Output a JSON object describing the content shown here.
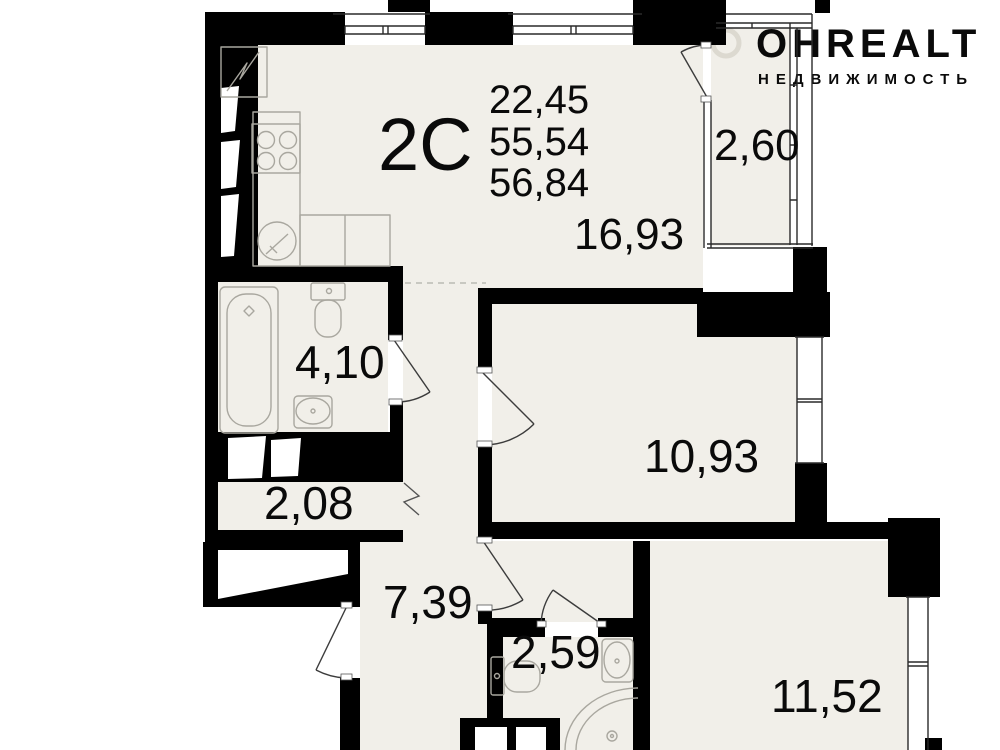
{
  "plan": {
    "unit": {
      "label": "2С",
      "area_living": "22,45",
      "area_total": "55,54",
      "area_total_with_summer": "56,84"
    },
    "rooms": {
      "kitchen_living": {
        "area": "16,93"
      },
      "balcony": {
        "area": "2,60"
      },
      "bathroom": {
        "area": "4,10"
      },
      "storage": {
        "area": "2,08"
      },
      "hallway": {
        "area": "7,39"
      },
      "bedroom": {
        "area": "10,93"
      },
      "wc": {
        "area": "2,59"
      },
      "room": {
        "area": "11,52"
      }
    },
    "watermark": {
      "brand": "ОНREALT",
      "tagline": "НЕДВИЖИМОСТЬ"
    },
    "colors": {
      "wall": "#000000",
      "floor": "#f1efe9",
      "fixture": "#a9a79f",
      "door": "#3c3c3c",
      "glazing": "#2a2a2a",
      "watermark": "#e9e8e4"
    }
  }
}
